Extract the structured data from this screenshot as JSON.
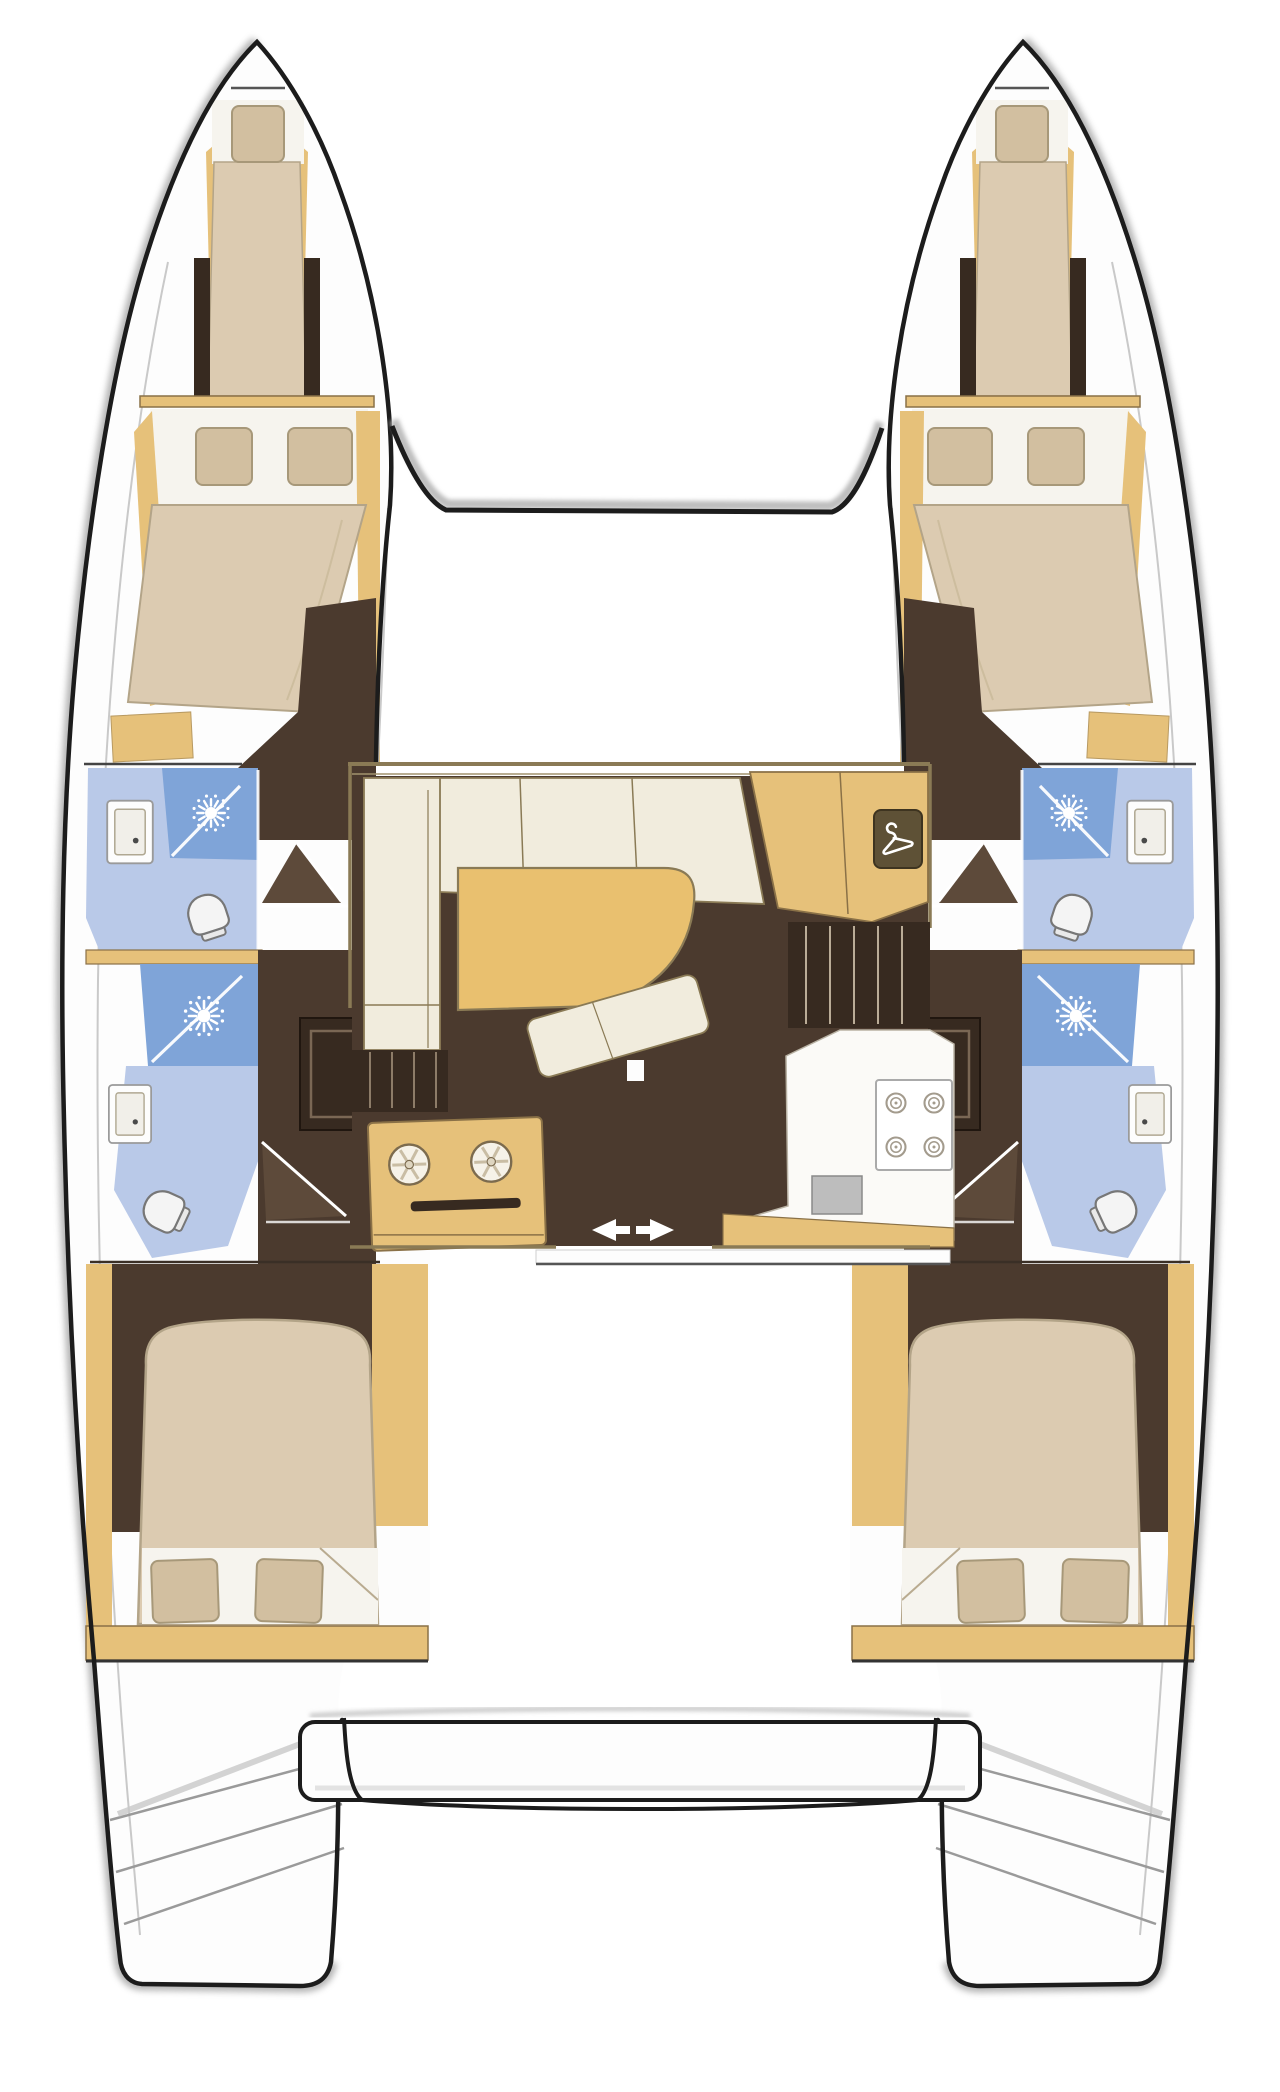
{
  "title": "Catamaran interior layout floor plan (top-down view)",
  "diagram": {
    "type": "boat-floor-plan",
    "vessel_type": "sailing catamaran, 4-cabin / 4-head layout",
    "view": "overhead deck plan, bows at top, sterns at bottom"
  },
  "colors": {
    "paper": "#ffffff",
    "ink": "#1c1c1c",
    "fuzz": "#a8a8a8",
    "wood": "#e6c17a",
    "wood_line": "#8a7147",
    "beige": "#dccbb1",
    "beige_deep": "#d2bfa0",
    "sheet": "#f6f4ee",
    "cream": "#f1ecdd",
    "cream_line": "#8a7a55",
    "floor": "#4b3a2e",
    "floor_dark": "#372a20",
    "floor_mid": "#5d4a3a",
    "blue": "#7fa4d8",
    "blue_light": "#b9c9e8",
    "table_tan": "#e9c06f",
    "white": "#fdfdfd",
    "gray_line": "#c9c9c9",
    "steel": "#bdbdbd",
    "burner": "#a39b8d",
    "icon_white": "#ffffff"
  },
  "hulls": {
    "port": {
      "position": "left",
      "rooms": [
        {
          "name": "forepeak berth",
          "fixtures": [
            "single berth",
            "pillow"
          ]
        },
        {
          "name": "forward cabin",
          "fixtures": [
            "double berth",
            "two pillows",
            "step"
          ]
        },
        {
          "name": "forward head",
          "fixtures": [
            "shower",
            "washbasin",
            "toilet"
          ]
        },
        {
          "name": "aft head",
          "fixtures": [
            "shower",
            "washbasin",
            "toilet",
            "locker"
          ]
        },
        {
          "name": "aft cabin",
          "fixtures": [
            "double berth",
            "two pillows"
          ]
        },
        {
          "name": "transom",
          "fixtures": [
            "swim steps"
          ]
        }
      ]
    },
    "starboard": {
      "position": "right",
      "mirror_of": "port",
      "rooms": "identical mirrored arrangement"
    }
  },
  "saloon": {
    "features": [
      "L-shaped sofa",
      "saloon table",
      "ottoman seat",
      "mast post",
      "galley sink console with twin round sinks",
      "galley counter",
      "four-burner stove",
      "square sink",
      "hanging locker with hanger symbol",
      "companionway steps to each hull",
      "sliding cockpit door with arrows"
    ]
  },
  "cockpit": {
    "features": [
      "aft bench seat",
      "transom platforms"
    ]
  },
  "icons": [
    {
      "name": "shower-icon",
      "meaning": "shower rose drawn as radiating sun"
    },
    {
      "name": "toilet-icon",
      "meaning": "marine toilet, bowl with cistern"
    },
    {
      "name": "sink-icon",
      "meaning": "rectangular washbasin with drain dot"
    },
    {
      "name": "galley-sink-icon",
      "meaning": "round sink with spoke drain cover"
    },
    {
      "name": "burner-icon",
      "meaning": "stove burner ring"
    },
    {
      "name": "hanger-icon",
      "meaning": "wardrobe / hanging locker"
    },
    {
      "name": "door-arrow-icon",
      "meaning": "sliding door direction arrows"
    }
  ]
}
